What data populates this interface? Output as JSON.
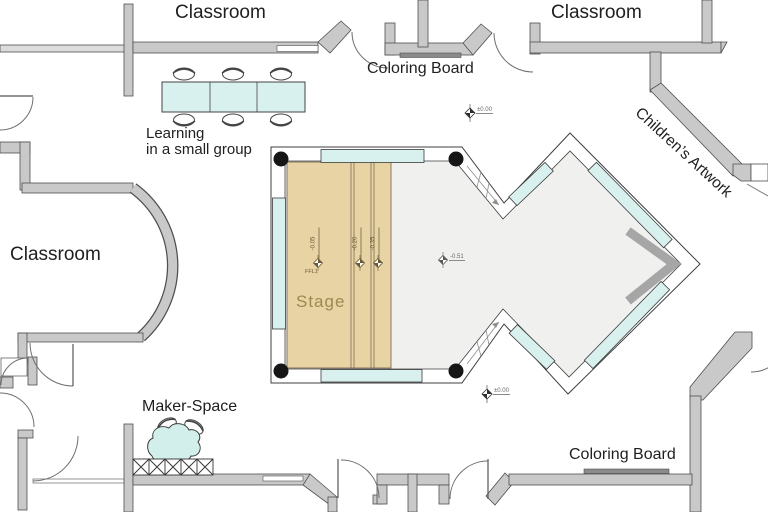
{
  "drawing": {
    "rooms": {
      "classroom_top_left": "Classroom",
      "classroom_top_right": "Classroom",
      "classroom_left": "Classroom",
      "stage": "Stage"
    },
    "features": {
      "coloring_board_top": "Coloring Board",
      "coloring_board_bottom": "Coloring Board",
      "learning_line1": "Learning",
      "learning_line2": "in a small group",
      "maker_space": "Maker-Space",
      "childrens_artwork": "Children’s Artwork"
    },
    "elevations": {
      "stage_value": "-0.05",
      "stage_sublabel": "FFL1",
      "step_mid": "-0.20",
      "step_low": "-0.35",
      "floor": "-0.51",
      "entry_top": "±0.00",
      "entry_bottom": "±0.00"
    },
    "colors": {
      "wall": "#c9c9c9",
      "wall_outline": "#4f4f4f",
      "glass": "#d9f1ee",
      "stage_wood": "#e7d3a4",
      "floor": "#f0f0ef",
      "board": "#8b8b8b",
      "shadow": "#a6a6a6",
      "stage_text": "#9c8a50"
    }
  }
}
